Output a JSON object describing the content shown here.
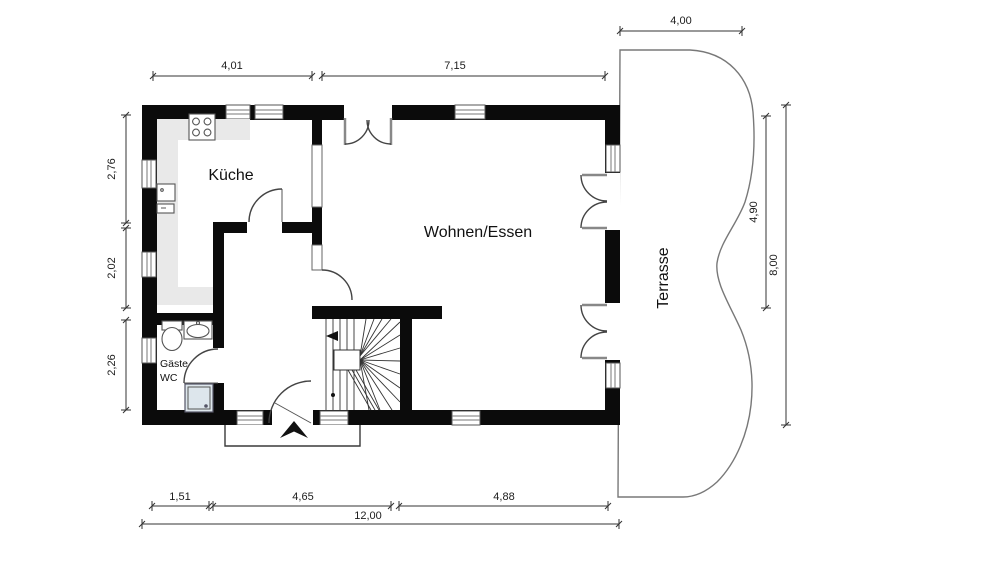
{
  "plan": {
    "rooms": {
      "kitchen": "Küche",
      "living": "Wohnen/Essen",
      "terrace": "Terrasse",
      "wc_line1": "Gäste",
      "wc_line2": "WC"
    },
    "dimensions": {
      "terrace_width": "4,00",
      "top": [
        "4,01",
        "7,15"
      ],
      "left": [
        "2,76",
        "2,02",
        "2,26"
      ],
      "right_inner": "4,90",
      "right_total": "8,00",
      "bottom": [
        "1,51",
        "4,65",
        "4,88"
      ],
      "bottom_total": "12,00"
    },
    "colors": {
      "wall": "#0b0b0b",
      "counter": "#e9e9e9",
      "shower": "#dde6ec",
      "background": "#ffffff"
    }
  }
}
